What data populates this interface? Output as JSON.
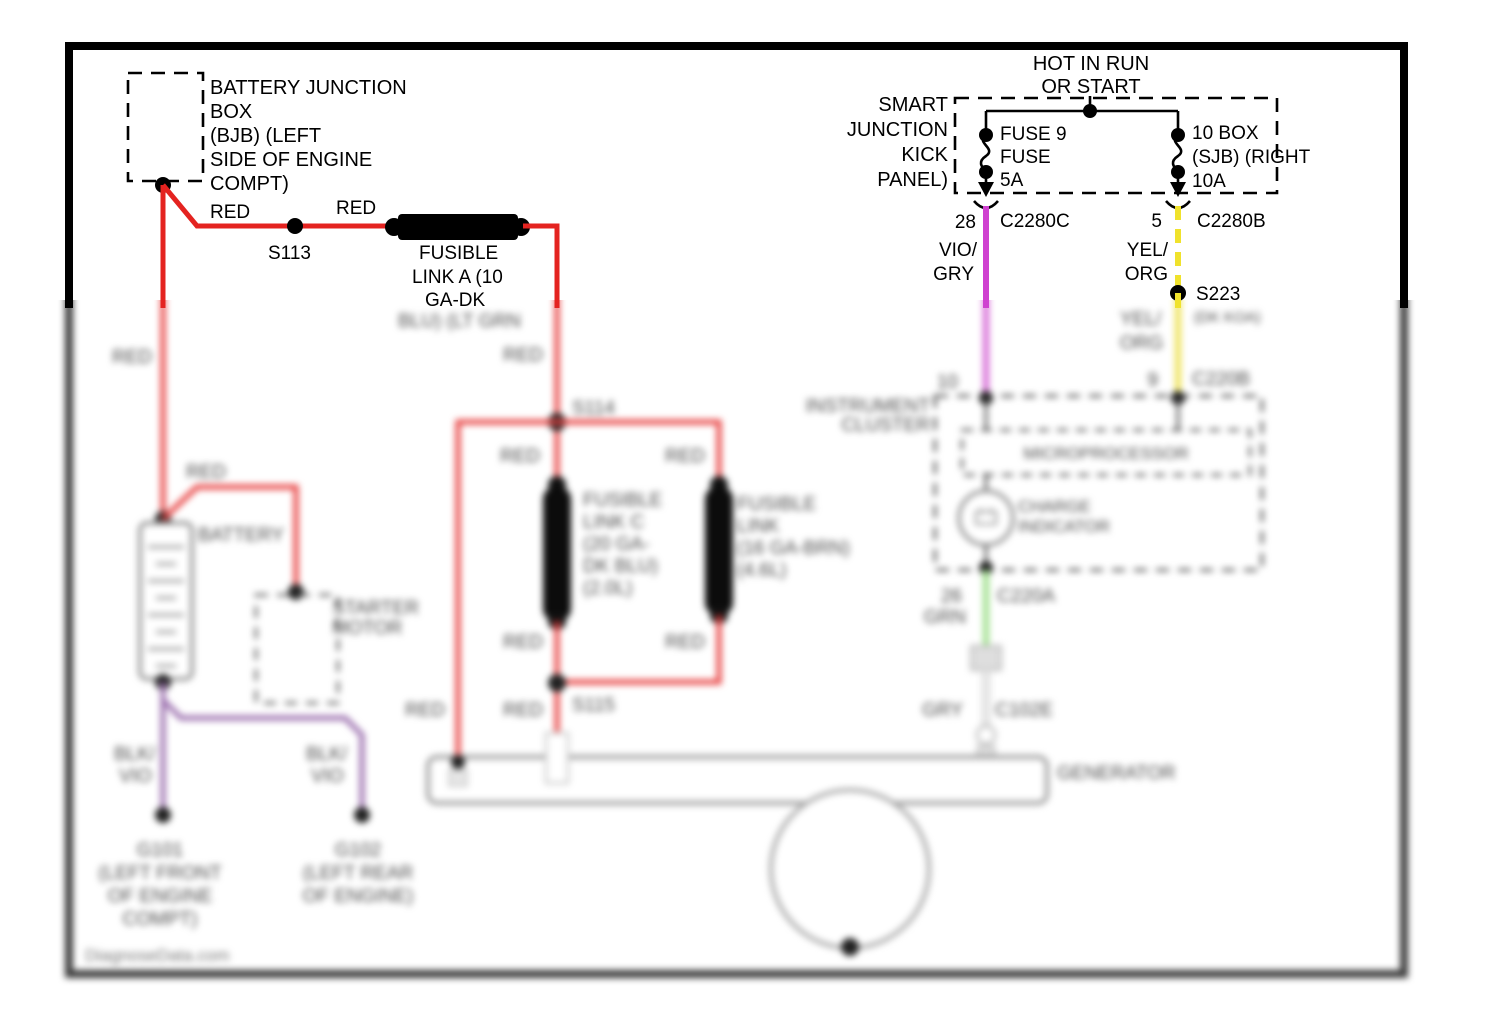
{
  "watermark": "DiagnoseData.com",
  "colors": {
    "wire_red": "#e42320",
    "wire_violet": "#cf42d0",
    "wire_yellow": "#f0e22c",
    "wire_green": "#9bdf8a",
    "wire_purple": "#9b6fae",
    "wire_gray": "#d9d9d9",
    "blur_text": "#4a4a4a",
    "border": "#000000"
  },
  "top": {
    "bjb": [
      "BATTERY JUNCTION",
      "BOX",
      "(BJB) (LEFT",
      "SIDE OF ENGINE",
      "COMPT)"
    ],
    "red1": "RED",
    "s113": "S113",
    "red2": "RED",
    "fl_a": [
      "FUSIBLE",
      "LINK A (10",
      "GA-DK"
    ],
    "hot": [
      "HOT IN RUN",
      "OR START"
    ],
    "sjb_left": [
      "SMART",
      "JUNCTION",
      "KICK",
      "PANEL)"
    ],
    "fuse9": [
      "FUSE 9",
      "FUSE",
      "5A"
    ],
    "fuse10": [
      "10 BOX",
      "(SJB) (RIGHT",
      "10A"
    ],
    "pin28": "28",
    "c2280c": "C2280C",
    "vio": [
      "VIO/",
      "GRY"
    ],
    "pin5": "5",
    "c2280b": "C2280B",
    "yel": [
      "YEL/",
      "ORG"
    ],
    "s223": "S223"
  },
  "blur": {
    "red": "RED",
    "fl_a_cont": "BLU) (LT GRN",
    "s114": "S114",
    "s115": "S115",
    "battery": "BATTERY",
    "starter": [
      "STARTER",
      "MOTOR"
    ],
    "fl_c": [
      "FUSIBLE",
      "LINK C",
      "(20 GA-",
      "DK BLU)",
      "(2.0L)"
    ],
    "fl_b": [
      "FUSIBLE",
      "LINK",
      "(16 GA-BRN)",
      "(4.6L)"
    ],
    "cluster": [
      "INSTRUMENT",
      "CLUSTER"
    ],
    "micro": "MICROPROCESSOR",
    "charge": [
      "CHARGE",
      "INDICATOR"
    ],
    "yel2": [
      "YEL/",
      "ORG"
    ],
    "yel2_note": "(DK KOA)",
    "pin10": "10",
    "pin9": "9",
    "c220b": "C220B",
    "pin26": "26",
    "c220a": "C220A",
    "grn": "GRN",
    "gry": "GRY",
    "c102e": "C102E",
    "generator": "GENERATOR",
    "blkvio": [
      "BLK/",
      "VIO"
    ],
    "g101": [
      "G101",
      "(LEFT FRONT",
      "OF ENGINE",
      "COMPT)"
    ],
    "g102": [
      "G102",
      "(LEFT REAR",
      "OF ENGINE)"
    ]
  }
}
